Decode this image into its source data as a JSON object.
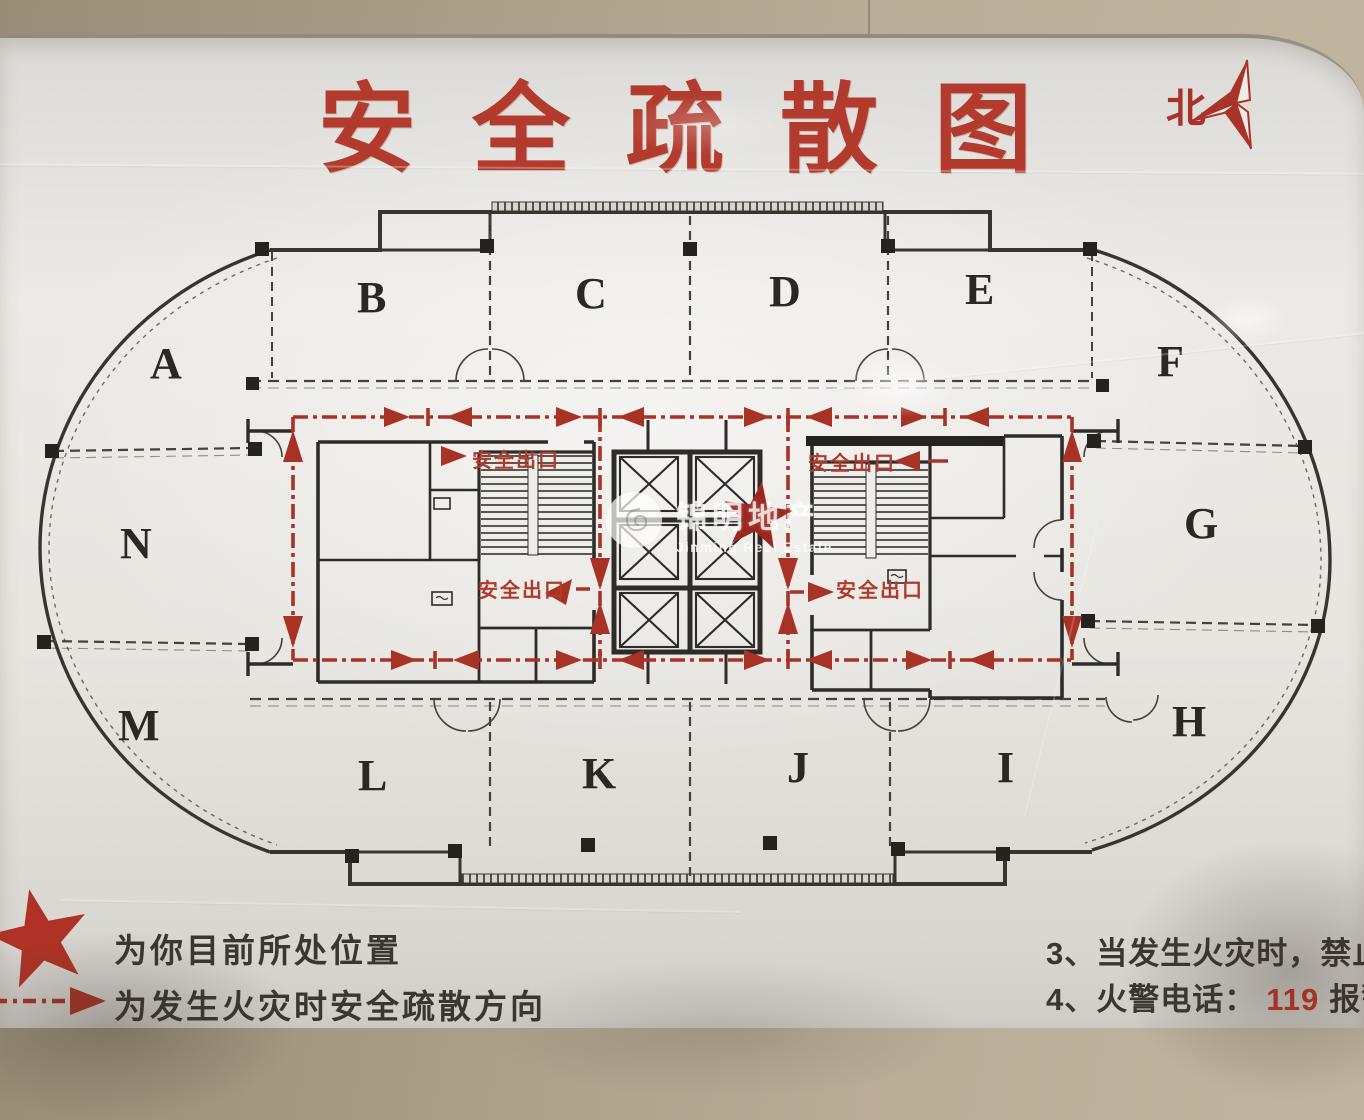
{
  "header": {
    "title": "安全疏散图",
    "north_label": "北"
  },
  "plan": {
    "sections": [
      {
        "label": "A"
      },
      {
        "label": "B"
      },
      {
        "label": "C"
      },
      {
        "label": "D"
      },
      {
        "label": "E"
      },
      {
        "label": "F"
      },
      {
        "label": "G"
      },
      {
        "label": "H"
      },
      {
        "label": "I"
      },
      {
        "label": "J"
      },
      {
        "label": "K"
      },
      {
        "label": "L"
      },
      {
        "label": "M"
      },
      {
        "label": "N"
      }
    ],
    "exit_labels": [
      {
        "text": "安全出口"
      },
      {
        "text": "安全出口"
      },
      {
        "text": "安全出口"
      },
      {
        "text": "安全出口"
      }
    ],
    "watermark": {
      "name_cn": "锦明地产",
      "name_en": "Jinming Real Estate"
    }
  },
  "legend": {
    "current_position_label": "为你目前所处位置",
    "evacuation_direction_label": "为发生火灾时安全疏散方向"
  },
  "notes": {
    "note3_prefix": "3、",
    "note3_text": "当发生火灾时，禁止使用电",
    "note4_prefix": "4、",
    "note4_label": "火警电话：",
    "note4_phone": "119",
    "note4_suffix": "报警电话"
  },
  "colors": {
    "accent_red": "#a93227",
    "wall_beige": "#ab9e89"
  }
}
